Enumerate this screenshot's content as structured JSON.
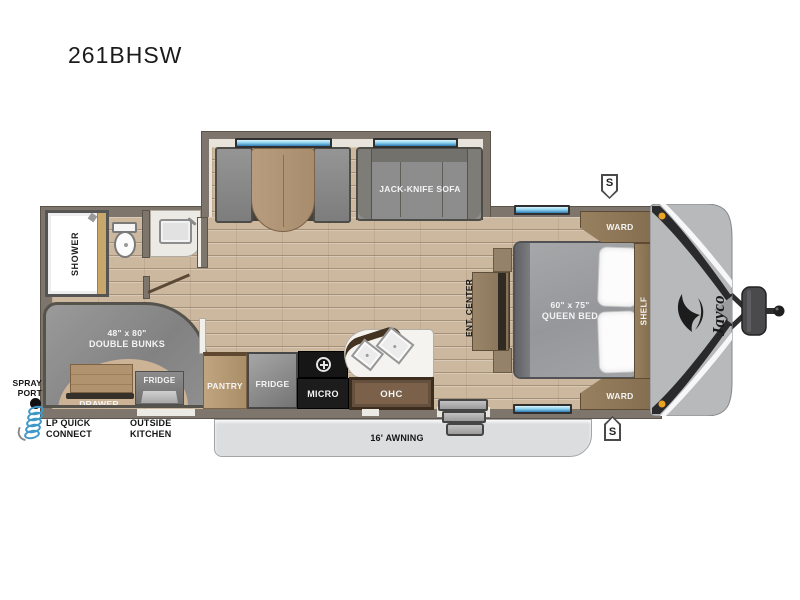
{
  "title": "261BHSW",
  "exterior": {
    "spray_port": [
      "SPRAY",
      "PORT"
    ],
    "lp_quick_connect": [
      "LP QUICK",
      "CONNECT"
    ],
    "outside_kitchen": [
      "OUTSIDE",
      "KITCHEN"
    ],
    "awning": "16' AWNING",
    "speaker_badge": "S",
    "brand_logo": "Jayco"
  },
  "bathroom": {
    "shower": "SHOWER"
  },
  "bunk_room": {
    "size": "48\" x 80\"",
    "name": "DOUBLE BUNKS",
    "fridge": "FRIDGE",
    "drawer": "DRAWER"
  },
  "kitchen": {
    "pantry": "PANTRY",
    "fridge": "FRIDGE",
    "micro": "MICRO",
    "ohc": "OHC"
  },
  "living_room": {
    "sofa": "JACK-KNIFE SOFA"
  },
  "bedroom": {
    "bed_size": "60\" x 75\"",
    "bed_name": "QUEEN BED",
    "ward_top": "WARD",
    "ward_bottom": "WARD",
    "shelf": "SHELF",
    "ent_center": "ENT. CENTER"
  },
  "colors": {
    "wall": "#7e766c",
    "floor_wood": "#ccb89f",
    "cabinet_wood": "#8a7258",
    "furniture_gray": "#8d8d8d",
    "window_blue": "#2f7cb4",
    "awning_gray": "#dbdddf",
    "front_cap": "#b7b9bb",
    "marker_orange": "#eda322",
    "hose_blue": "#3f98c8"
  }
}
